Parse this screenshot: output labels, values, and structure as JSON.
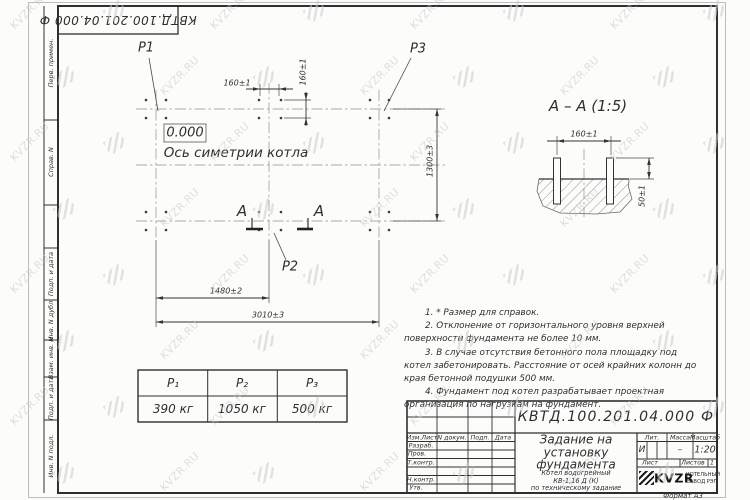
{
  "sheet": {
    "format_label": "Формат А3",
    "watermark_text": "KVZR.RU"
  },
  "side_strip": {
    "items": [
      "Перв. примен.",
      "Справ. N",
      "",
      "Подп. и дата",
      "Инв. N дубл.",
      "Взам. инв. N",
      "Подп. и дата",
      "Инв. N подл."
    ]
  },
  "plan": {
    "elevation_mark": "0.000",
    "axis_label": "Ось симетрии котла",
    "label_p1": "Р1",
    "label_p2": "Р2",
    "label_p3": "Р3",
    "section_letter_left": "А",
    "section_letter_right": "А",
    "dim_160_top": "160±1",
    "dim_160_side": "160±1",
    "dim_1300": "1300±3",
    "dim_1480": "1480±2",
    "dim_3010": "3010±3"
  },
  "section_view": {
    "title": "А – А (1:5)",
    "dim_160": "160±1",
    "dim_50": "50±1"
  },
  "notes": {
    "n1": "1. * Размер для справок.",
    "n2": "2. Отклонение от горизонтального уровня верхней поверхности фундамента не более 10 мм.",
    "n3": "3. В случае отсутствия бетонного пола площадку под котел забетонировать. Расстояние от осей крайних колонн до края бетонной подушки 500 мм.",
    "n4": "4. Фундамент под котел разрабатывает проектная организация по нагрузкам на фундамент."
  },
  "load_table": {
    "headers": [
      "Р₁",
      "Р₂",
      "Р₃"
    ],
    "values": [
      "390 кг",
      "1050 кг",
      "500 кг"
    ]
  },
  "title_block": {
    "doc_number": "КВТД.100.201.04.000 Ф",
    "title": "Задание на установку фундамента",
    "subtitle": [
      "Котел водогрейный",
      "КВ-1,16 Д (К)",
      "по техническому задание"
    ],
    "cols": [
      "Изм.Лист",
      "N докум.",
      "Подп.",
      "Дата"
    ],
    "rows": [
      "Разраб.",
      "Пров.",
      "Т.контр.",
      "",
      "Н.контр.",
      "Утв."
    ],
    "lit_label": "Лит.",
    "lit_value": "И",
    "mass_label": "Масса",
    "mass_value": "–",
    "scale_label": "Масштаб",
    "scale_value": "1:20",
    "sheet_label": "Лист",
    "sheets_label": "Листов",
    "sheets_value": "1",
    "logo_text": "KVZR",
    "logo_caption": [
      "КОТЕЛЬНЫЙ",
      "ЗАВОД РЭП"
    ]
  }
}
